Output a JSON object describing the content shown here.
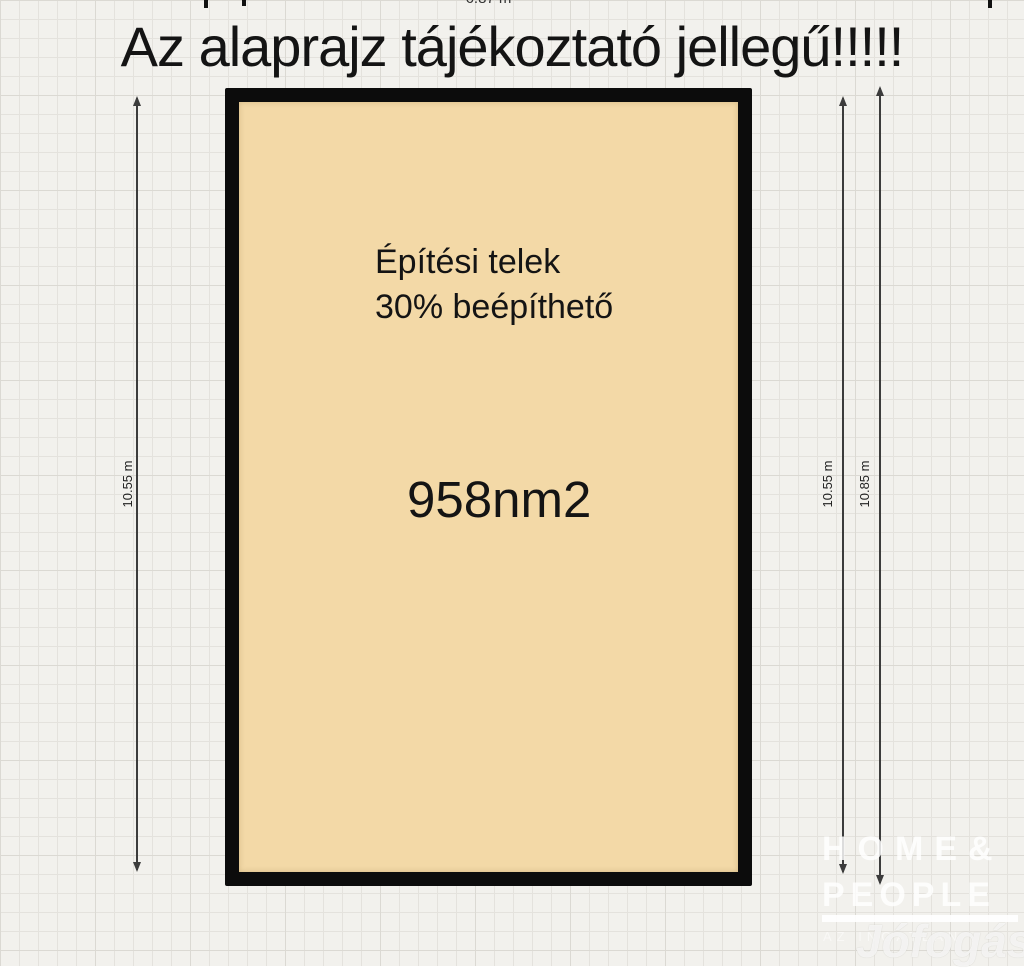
{
  "notice": {
    "text": "Az alaprajz tájékoztató jellegű!!!!!"
  },
  "plot": {
    "type_line1": "Építési telek",
    "type_line2": "30% beépíthető",
    "area_label": "958nm2"
  },
  "dimensions": {
    "top_label": "6.87 m",
    "left_label": "10.55 m",
    "right_inner_label": "10.55 m",
    "right_outer_label": "10.85 m"
  },
  "watermarks": {
    "agency_line1": "HOME&",
    "agency_line2": "PEOPLE",
    "agency_subtext": "AZ INGATLAN",
    "marketplace": "Jófogás"
  },
  "colors": {
    "page_bg": "#f2f1ed",
    "grid_line": "#e4e2dd",
    "grid_line_strong": "#dbd9d3",
    "plot_fill": "#f3d9a7",
    "plot_border": "#0c0c0c",
    "ink": "#141414",
    "dim_line": "#3c3c3c"
  }
}
